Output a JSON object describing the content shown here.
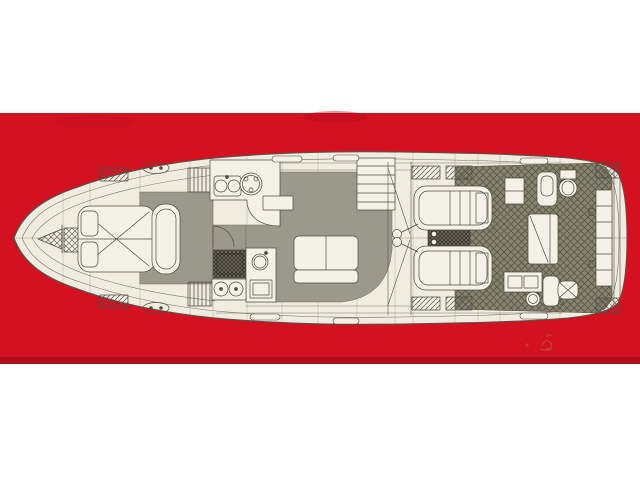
{
  "scene": {
    "kind": "yacht-deck-plan-brochure-scan",
    "canvas": {
      "width": 640,
      "height": 480
    },
    "colors": {
      "page_white": "#ffffff",
      "red_panel": "#d31120",
      "red_panel_dark": "#a80d1b",
      "red_smudge": "#b30e1c",
      "paper_cream": "#f0ecdf",
      "paper_bright": "#f4f1e6",
      "floor_gray": "#9b988c",
      "floor_gray_edge": "#6f6c60",
      "hatch_floor_bg": "#87836f",
      "hatch_floor_line": "#5a5748",
      "stove_hatch_bg": "#716e5f",
      "stove_hatch_line": "#33312a",
      "line_ink": "#4f4c43",
      "watermark_red": "#c0554a"
    },
    "red_panel_bounds": {
      "top": 113,
      "bottom": 364,
      "left": 0,
      "right": 640
    },
    "regions": [
      {
        "name": "bow-pulpit"
      },
      {
        "name": "foredeck"
      },
      {
        "name": "forward-cabin-berth"
      },
      {
        "name": "galley"
      },
      {
        "name": "salon-settee"
      },
      {
        "name": "companionway-stairs"
      },
      {
        "name": "engine-room-twin-engines"
      },
      {
        "name": "aft-cabin-berth"
      },
      {
        "name": "aft-head-port"
      },
      {
        "name": "aft-head-starboard"
      },
      {
        "name": "transom-swim-steps"
      }
    ]
  }
}
